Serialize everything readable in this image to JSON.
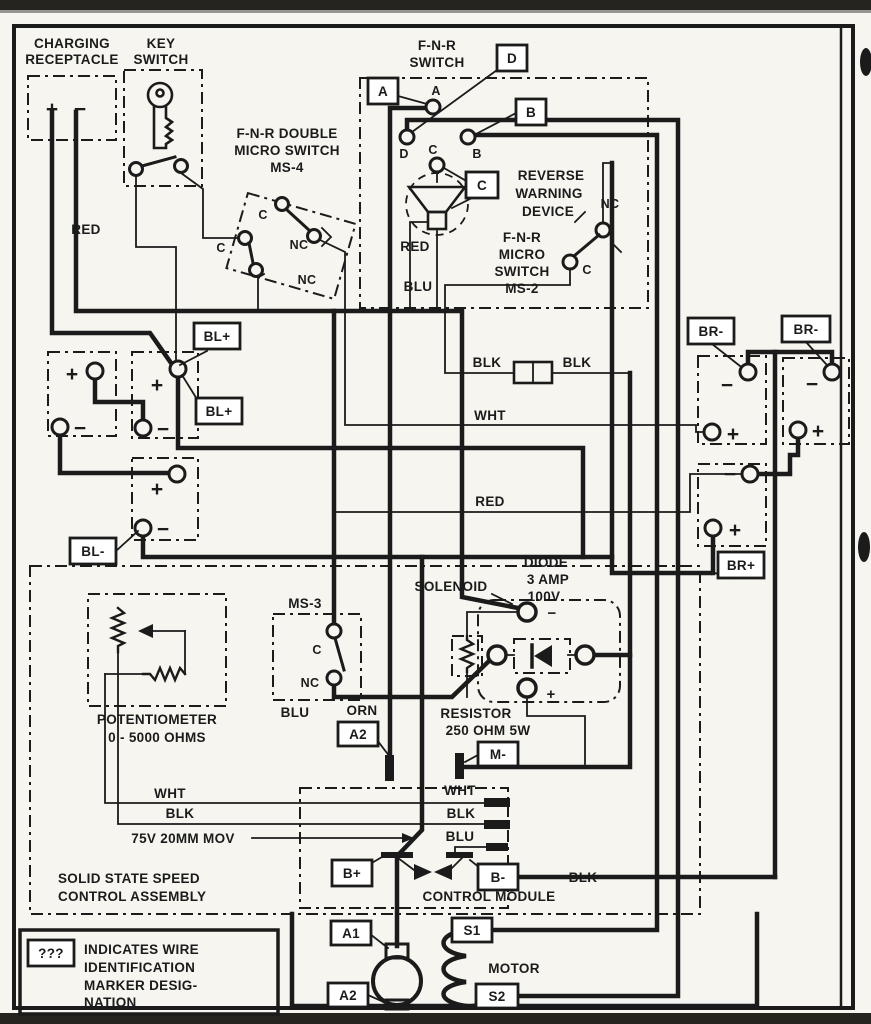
{
  "colors": {
    "ink": "#1b1b1b",
    "paper": "#f6f5f0"
  },
  "labels": {
    "charging1": "CHARGING",
    "charging2": "RECEPTACLE",
    "key1": "KEY",
    "key2": "SWITCH",
    "ms4l1": "F-N-R DOUBLE",
    "ms4l2": "MICRO SWITCH",
    "ms4l3": "MS-4",
    "fnr1": "F-N-R",
    "fnr2": "SWITCH",
    "tA": "A",
    "tB": "B",
    "tC": "C",
    "tD": "D",
    "rev1": "REVERSE",
    "rev2": "WARNING",
    "rev3": "DEVICE",
    "ms2l1": "F-N-R",
    "ms2l2": "MICRO",
    "ms2l3": "SWITCH",
    "ms2l4": "MS-2",
    "nc": "NC",
    "c": "C",
    "red": "RED",
    "blu": "BLU",
    "blk": "BLK",
    "wht": "WHT",
    "orn": "ORN",
    "blplus": "BL+",
    "blminus": "BL-",
    "brminus": "BR-",
    "brplus": "BR+",
    "plus": "+",
    "minus": "−",
    "diode1": "DIODE",
    "diode2": "3 AMP",
    "diode3": "100V",
    "solenoid": "SOLENOID",
    "res1": "RESISTOR",
    "res2": "250 OHM 5W",
    "pot1": "POTENTIOMETER",
    "pot2": "0 - 5000 OHMS",
    "ms3": "MS-3",
    "a2": "A2",
    "mminus": "M-",
    "mov": "75V 20MM MOV",
    "sssca1": "SOLID STATE SPEED",
    "sssca2": "CONTROL ASSEMBLY",
    "bplus": "B+",
    "bminus": "B-",
    "ctrl": "CONTROL MODULE",
    "a1": "A1",
    "s1": "S1",
    "s2": "S2",
    "motor": "MOTOR",
    "q": "???",
    "leg1": "INDICATES WIRE",
    "leg2": "IDENTIFICATION",
    "leg3": "MARKER DESIG-",
    "leg4": "NATION"
  }
}
